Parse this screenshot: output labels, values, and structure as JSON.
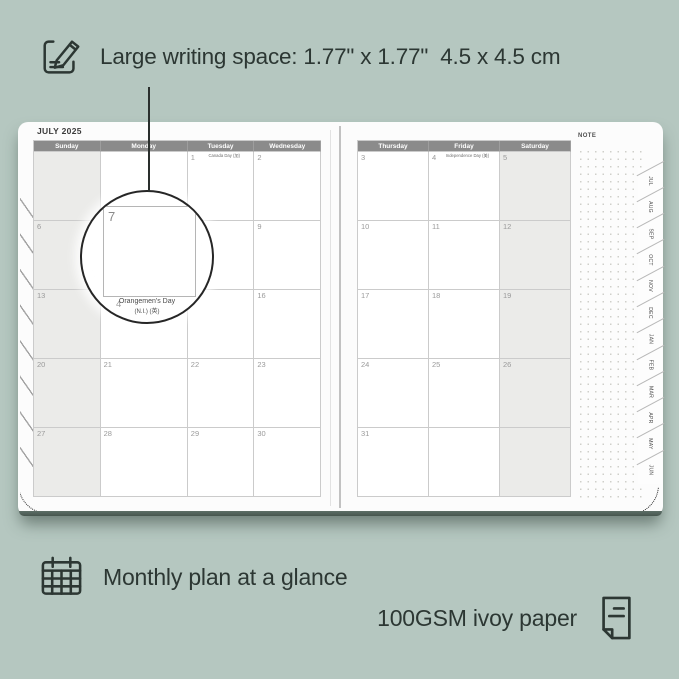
{
  "colors": {
    "background": "#b5c7c0",
    "page": "#fcfcfc",
    "ink": "#2c3733",
    "header_band": "#8b8b8b",
    "weekend_shade": "#ebebe9",
    "grid_line": "#cbcbcb",
    "page_bottom_edge": "#4d5d56"
  },
  "annotations": {
    "top": {
      "icon": "note-pencil-icon",
      "text": "Large writing space: 1.77\" x 1.77\"  4.5 x 4.5 cm"
    },
    "bottom_left": {
      "icon": "calendar-grid-icon",
      "text": "Monthly plan at a glance"
    },
    "bottom_right": {
      "icon": "paper-sheet-icon",
      "text": "100GSM ivoy paper"
    }
  },
  "planner": {
    "title": "JULY 2025",
    "note_label": "NOTE",
    "left_page": {
      "headers": [
        "Sunday",
        "Monday",
        "Tuesday",
        "Wednesday"
      ],
      "shaded_column": 0,
      "rows": [
        [
          {},
          {},
          {
            "n": "1",
            "h": "Canada Day (加)"
          },
          {
            "n": "2"
          }
        ],
        [
          {
            "n": "6"
          },
          {
            "n": "7"
          },
          {
            "n": "8"
          },
          {
            "n": "9"
          }
        ],
        [
          {
            "n": "13"
          },
          {
            "n": "14",
            "h": "Orangemen's Day (N.I.) (英)"
          },
          {
            "n": "15"
          },
          {
            "n": "16"
          }
        ],
        [
          {
            "n": "20"
          },
          {
            "n": "21"
          },
          {
            "n": "22"
          },
          {
            "n": "23"
          }
        ],
        [
          {
            "n": "27"
          },
          {
            "n": "28"
          },
          {
            "n": "29"
          },
          {
            "n": "30"
          }
        ]
      ]
    },
    "right_page": {
      "headers": [
        "Thursday",
        "Friday",
        "Saturday"
      ],
      "shaded_column": 2,
      "rows": [
        [
          {
            "n": "3"
          },
          {
            "n": "4",
            "h": "Independence Day (美)"
          },
          {
            "n": "5"
          }
        ],
        [
          {
            "n": "10"
          },
          {
            "n": "11"
          },
          {
            "n": "12"
          }
        ],
        [
          {
            "n": "17"
          },
          {
            "n": "18"
          },
          {
            "n": "19"
          }
        ],
        [
          {
            "n": "24"
          },
          {
            "n": "25"
          },
          {
            "n": "26"
          }
        ],
        [
          {
            "n": "31"
          },
          {},
          {}
        ]
      ]
    },
    "tabs": [
      "JUL",
      "AUG",
      "SEP",
      "OCT",
      "NOV",
      "DEC",
      "JAN",
      "FEB",
      "MAR",
      "APR",
      "MAY",
      "JUN"
    ],
    "magnifier": {
      "day": "7",
      "partial_day": "4",
      "holiday_line1": "Orangemen's Day",
      "holiday_line2": "(N.I.) (英)"
    }
  }
}
